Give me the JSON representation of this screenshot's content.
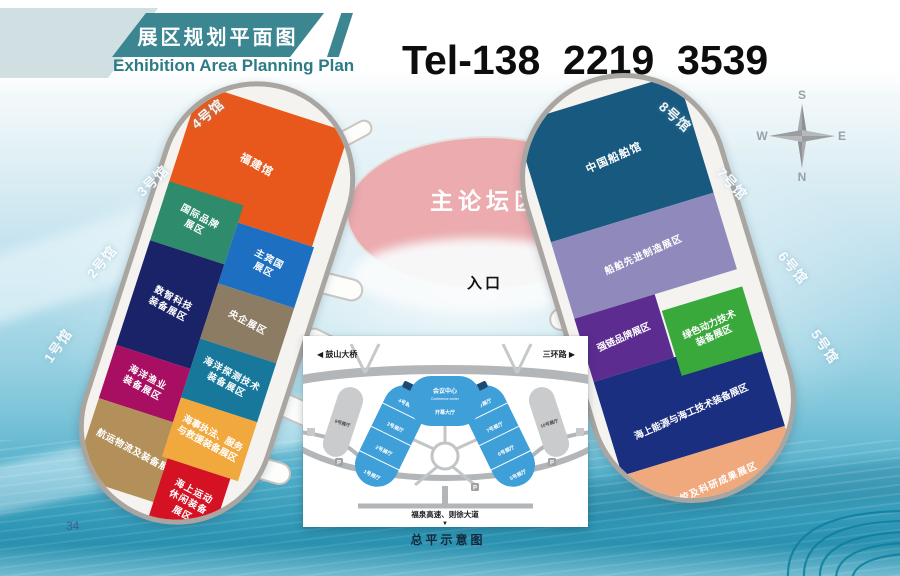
{
  "header": {
    "title_zh": "展区规划平面图",
    "title_en": "Exhibition Area Planning Plan",
    "phone": "Tel-138  2219  3539"
  },
  "compass": {
    "top": "S",
    "bottom": "N",
    "left": "W",
    "right": "E"
  },
  "center": {
    "forum_label": "主论坛区",
    "entrance_label": "入口"
  },
  "left_pavilion": {
    "hall_labels": [
      "4号馆",
      "3号馆",
      "2号馆",
      "1号馆"
    ],
    "zones": [
      {
        "name": "福建馆",
        "color": "#e8581c"
      },
      {
        "name": "国际品牌展区",
        "color": "#2e8c6c"
      },
      {
        "name": "主宾国展区",
        "color": "#1d6fc2"
      },
      {
        "name": "数智科技装备展区",
        "color": "#1b2368"
      },
      {
        "name": "央企展区",
        "color": "#8d7c64"
      },
      {
        "name": "海洋探测技术装备展区",
        "color": "#17789b"
      },
      {
        "name": "海洋渔业装备展区",
        "color": "#a80f62"
      },
      {
        "name": "航运物流及装备展区",
        "color": "#b3905a"
      },
      {
        "name": "海事执法、服务与救援装备展区",
        "color": "#f1a93e"
      },
      {
        "name": "海上运动休闲装备展区",
        "color": "#d41223"
      }
    ]
  },
  "right_pavilion": {
    "hall_labels": [
      "8号馆",
      "7号馆",
      "6号馆",
      "5号馆"
    ],
    "zones": [
      {
        "name": "中国船舶馆",
        "color": "#17597f"
      },
      {
        "name": "船舶先进制造展区",
        "color": "#9089bc"
      },
      {
        "name": "强链品牌展区",
        "color": "#5c2c90"
      },
      {
        "name": "海上能源与海工技术装备展区",
        "color": "#1b2f80"
      },
      {
        "name": "绿色动力技术装备展区",
        "color": "#3aa93c"
      },
      {
        "name": "院校及科研成果展区",
        "color": "#f0a87d"
      }
    ]
  },
  "inset_map": {
    "caption": "总平示意图",
    "top_left_road": "◀ 鼓山大桥",
    "top_right_road": "三环路 ▶",
    "bottom_road": "福泉高速、则徐大道",
    "bottom_arrow": "▼",
    "conference_center_zh": "会议中心",
    "conference_center_en": "Conference center",
    "opening_hall": "开幕大厅",
    "left_halls": [
      "4号展厅",
      "3号展厅",
      "2号展厅",
      "1号展厅"
    ],
    "right_halls": [
      "8号展厅",
      "7号展厅",
      "6号展厅",
      "5号展厅"
    ],
    "side_halls": [
      "9号展厅",
      "10号展厅"
    ],
    "parking": "P"
  },
  "page_number": "34",
  "colors": {
    "header_teal": "#3c8691",
    "header_light": "#cfdfe2",
    "forum_pink": "#ecabae",
    "inset_blue": "#3f9fd8"
  }
}
